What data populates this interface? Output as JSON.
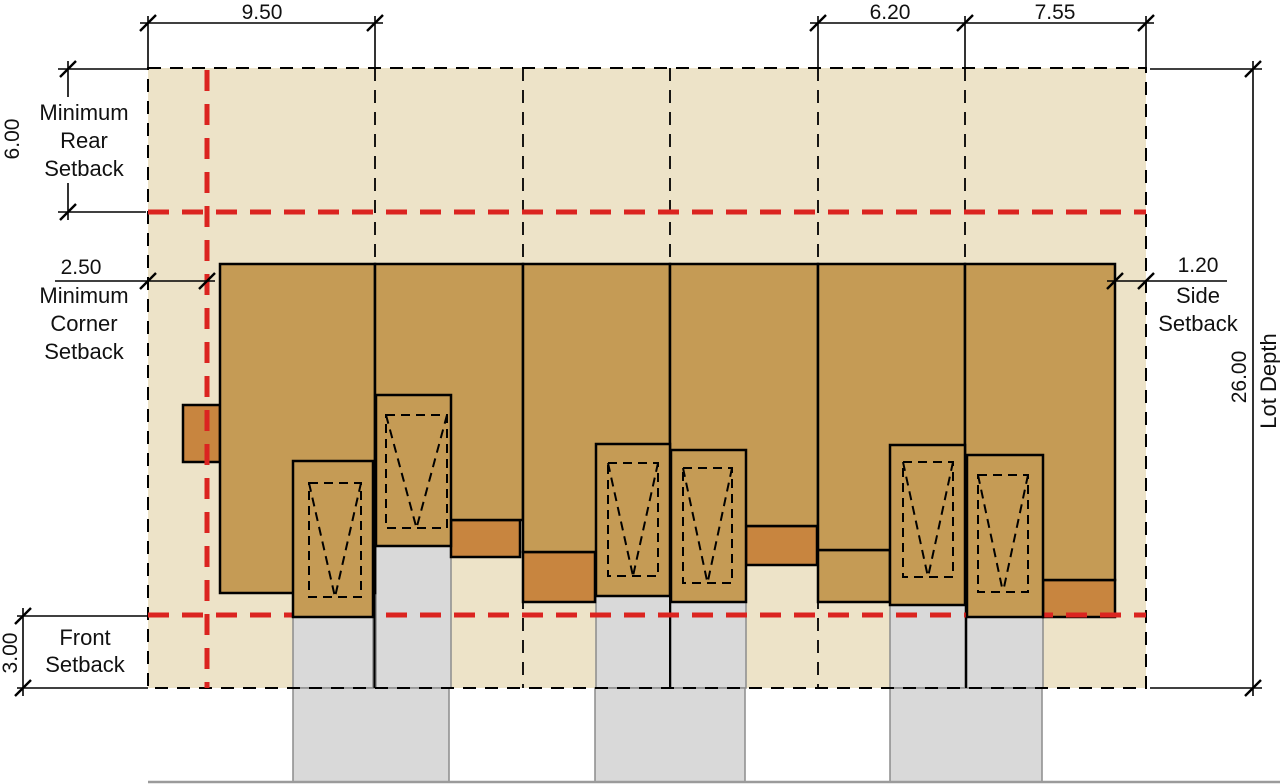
{
  "diagram_type": "zoning-setback-site-plan",
  "dimensions": {
    "corner_lot_width": "9.50",
    "interior_lot_width": "6.20",
    "end_lot_width": "7.55",
    "rear_setback": "6.00",
    "corner_setback": "2.50",
    "front_setback": "3.00",
    "side_setback": "1.20",
    "lot_depth": "26.00"
  },
  "labels": {
    "rear_line1": "Minimum",
    "rear_line2": "Rear",
    "rear_line3": "Setback",
    "corner_line1": "Minimum",
    "corner_line2": "Corner",
    "corner_line3": "Setback",
    "front_line1": "Front",
    "front_line2": "Setback",
    "side_line1": "Side",
    "side_line2": "Setback",
    "lot_depth_label": "Lot Depth"
  },
  "colors": {
    "lot": "#EDE3C8",
    "building": "#C59B55",
    "porch": "#C8853F",
    "driveway": "#D9D9D9",
    "drivewayBorder": "#8C8C8C",
    "setback": "#DB2420",
    "street": "#9B9B9B"
  }
}
